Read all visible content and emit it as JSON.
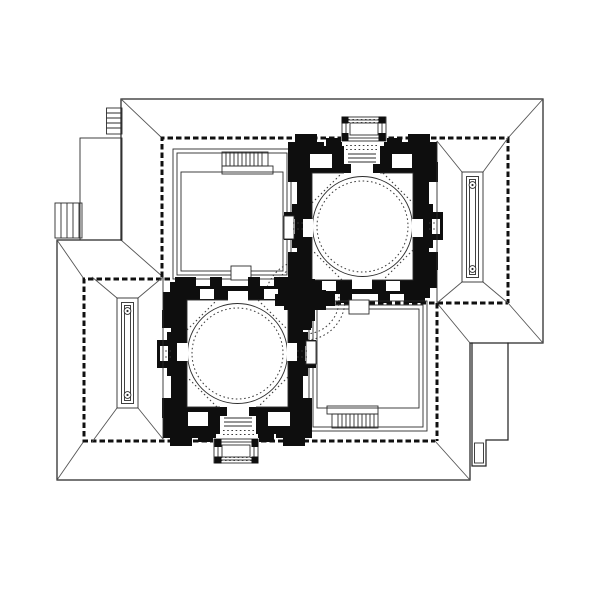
{
  "meta": {
    "domain": "architectural-plan-drawing",
    "description": "Black and white combined plan and roof plan of two identical domed pavilions joined diagonally corner to corner; each pavilion has a square domed hall with heavy black poche walls, a side room with a staircase, a walled court containing a long reflecting pool with two round fountain basins, and a projecting entrance porch.",
    "visible_text": "none"
  },
  "colors": {
    "paper": "#ffffff",
    "ink": "#262626",
    "poche": "#0e0e0e",
    "hip": "#555555",
    "dots": "#3a3a3a",
    "thin": "#2c2c2c",
    "wall": "#101010"
  },
  "drawing": {
    "buildings": [
      {
        "id": "upper-east-pavilion",
        "porch_side": "north",
        "rooms": [
          "stair-room (west)",
          "domed-hall (center)",
          "pool-court (east)"
        ],
        "pool_fountains": 2,
        "exterior_stairs": [
          "northwest-ladder-stair",
          "west-side-stair"
        ]
      },
      {
        "id": "lower-west-pavilion",
        "porch_side": "south",
        "rooms": [
          "pool-court (west)",
          "domed-hall (center)",
          "stair-room (east)"
        ],
        "pool_fountains": 2,
        "annex": "southeast-stepped-wing"
      }
    ],
    "junction": "corner-to-corner cruciform black pier cluster with dotted vault rings",
    "dome_motif": "solid circle with inner dotted ring and dotted octagon chamfers",
    "counts": {
      "domes": 2,
      "pools": 2,
      "fountain_basins": 4,
      "entrance_porches": 2,
      "stair_flights": 4
    }
  }
}
